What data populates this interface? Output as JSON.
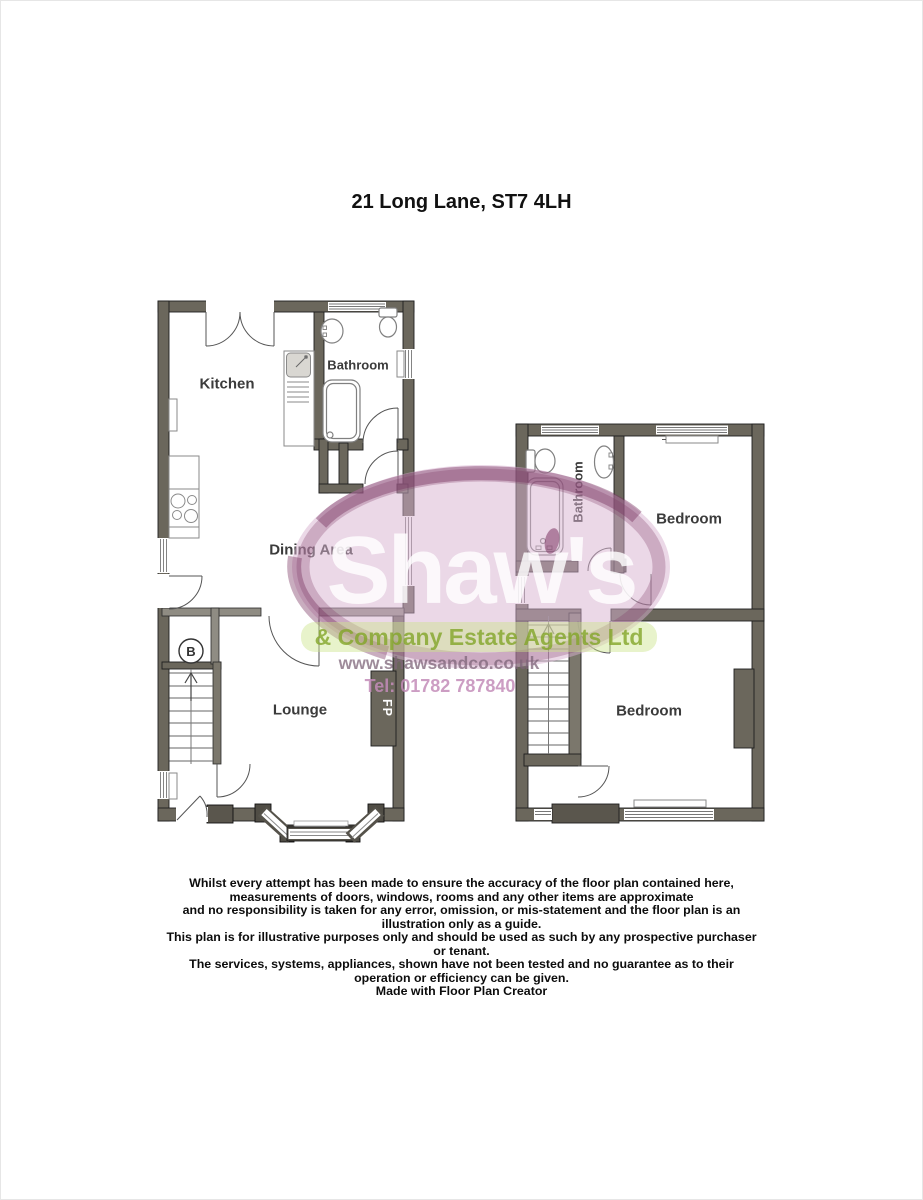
{
  "page": {
    "title": "21 Long Lane, ST7 4LH"
  },
  "ground_floor": {
    "rooms": {
      "kitchen": "Kitchen",
      "bathroom": "Bathroom",
      "dining_area": "Dining Area",
      "lounge": "Lounge"
    },
    "markers": {
      "boiler": "B",
      "fireplace": "FP"
    }
  },
  "first_floor": {
    "rooms": {
      "bathroom": "Bathroom",
      "bedroom_front": "Bedroom",
      "bedroom_rear": "Bedroom"
    }
  },
  "watermark": {
    "brand": "Shaw's",
    "tagline": "& Company Estate Agents Ltd",
    "website": "www.shawsandco.co.uk",
    "phone": "Tel: 01782 787840",
    "colors": {
      "pink": "#dab2d0",
      "plum": "#7d3764",
      "green": "#87aa2d",
      "lavender": "#8a6f84"
    }
  },
  "disclaimer": {
    "lines": [
      "Whilst every attempt has been made to ensure the accuracy of the floor plan contained here,",
      "measurements of doors, windows, rooms and any other items are approximate",
      "and no responsibility is taken for any error, omission, or mis-statement and the floor plan is an",
      "illustration only as a guide.",
      "This plan is for illustrative purposes only and should be used as such by any prospective purchaser",
      "or tenant.",
      "The services, systems, appliances, shown have not been tested and no guarantee as to their",
      "operation or efficiency can be given."
    ],
    "credit": "Made with Floor Plan Creator"
  }
}
